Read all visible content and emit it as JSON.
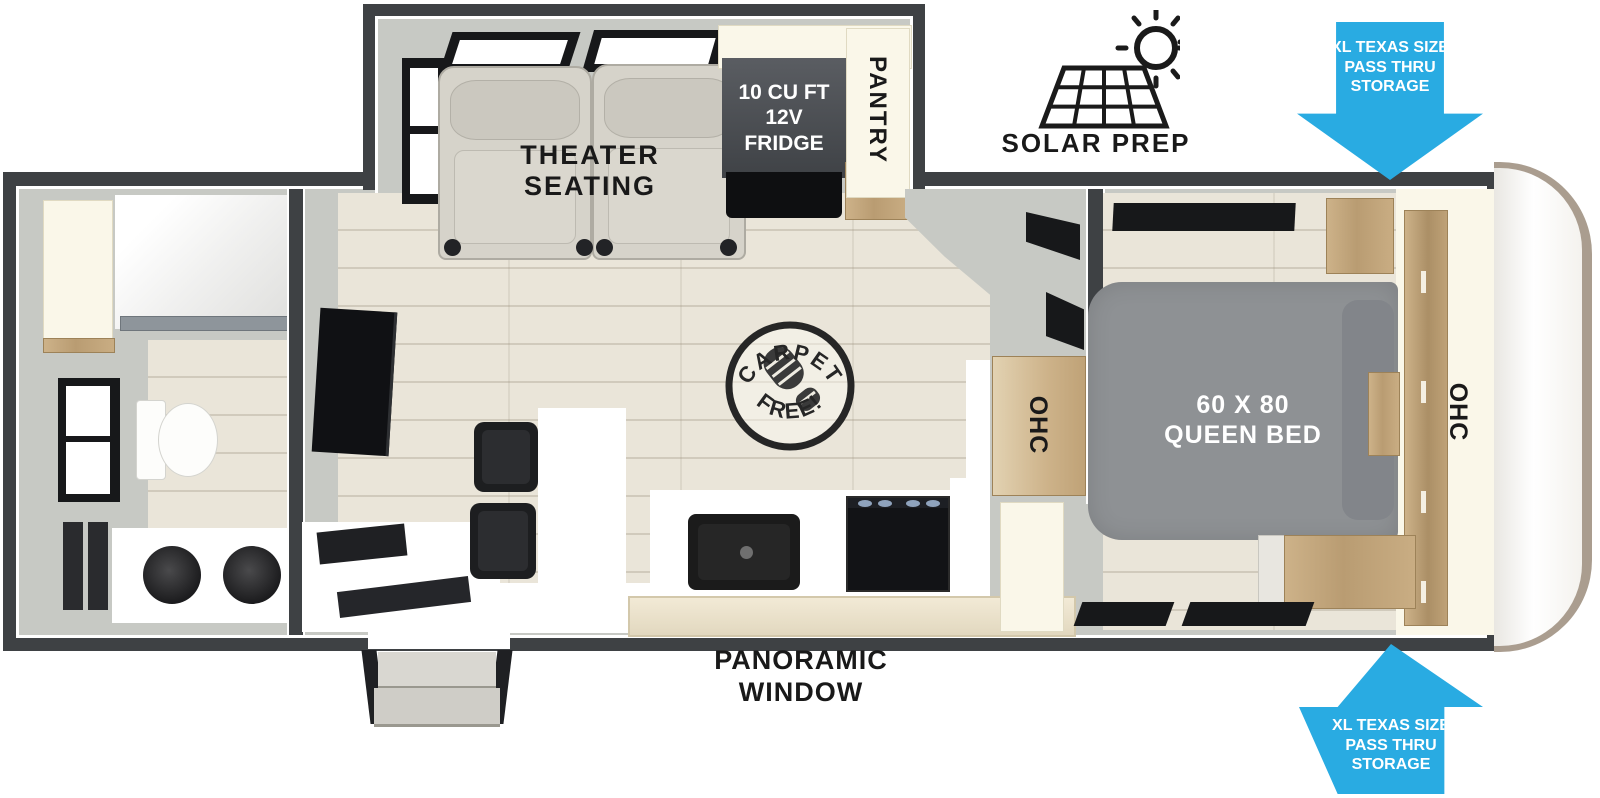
{
  "labels": {
    "theater_seating": {
      "line1": "THEATER",
      "line2": "SEATING"
    },
    "fridge": {
      "line1": "10 CU FT",
      "line2": "12V",
      "line3": "FRIDGE"
    },
    "pantry": "PANTRY",
    "solar_prep": "SOLAR PREP",
    "storage_arrow": {
      "line1": "XL TEXAS SIZE",
      "line2": "PASS THRU",
      "line3": "STORAGE"
    },
    "carpet_badge": {
      "top": "CARPET",
      "bottom": "FREE!"
    },
    "queen_bed": {
      "line1": "60 X 80",
      "line2": "QUEEN BED"
    },
    "ohc_kitchen": "OHC",
    "ohc_front": "OHC",
    "panoramic_window": {
      "line1": "PANORAMIC",
      "line2": "WINDOW"
    }
  },
  "icons": {
    "solar_panel": "solar-panel-grid",
    "sun": "sun-with-rays",
    "boot_print": "boot-print",
    "storage_arrow_top": "down-arrow",
    "storage_arrow_bottom": "up-arrow"
  },
  "colors": {
    "arrow_blue": "#29ABE2",
    "wall_dark": "#3E4144",
    "interior_gray": "#C7C9C4",
    "floor_wood": "#EAE5D9",
    "cabinet_wood": "#C3A67E",
    "cream": "#FAF7E9",
    "bed_gray": "#8E9194",
    "label_black": "#191919",
    "label_white": "#FFFFFF"
  }
}
